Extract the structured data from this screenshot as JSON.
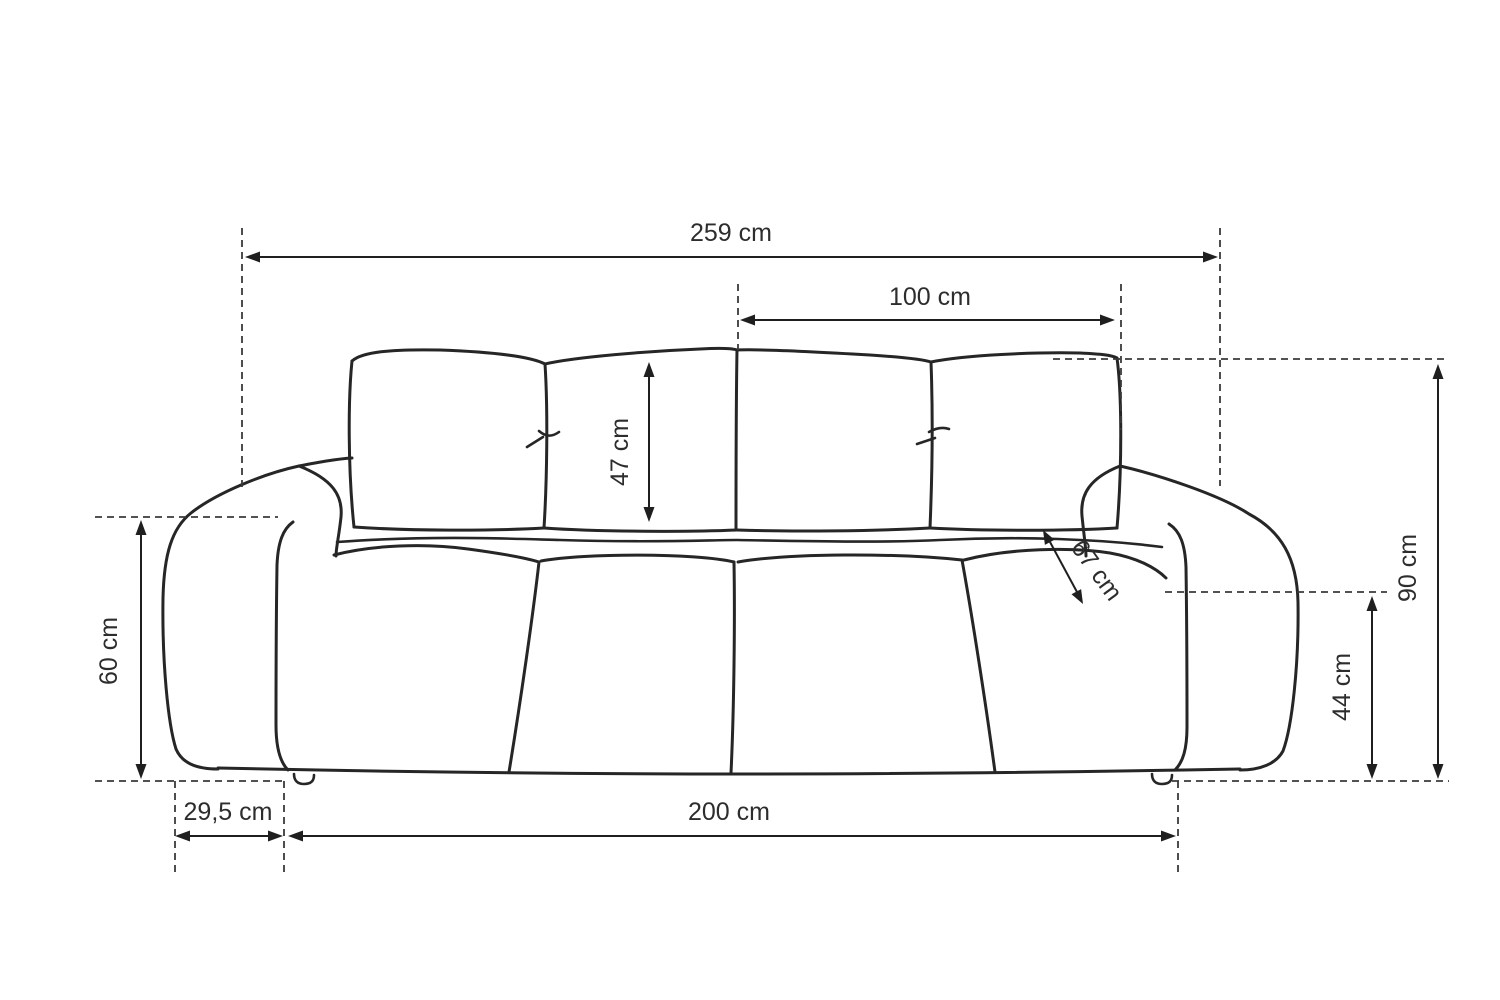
{
  "diagram": {
    "subject": "sofa front-view dimension drawing",
    "unit": "cm",
    "dimensions": {
      "total_width": "259 cm",
      "backrest_cushion_pair_width": "100 cm",
      "back_cushion_height": "47 cm",
      "seat_depth": "67 cm",
      "total_height": "90 cm",
      "seat_height": "44 cm",
      "armrest_height": "60 cm",
      "armrest_width": "29,5 cm",
      "seat_width": "200 cm"
    },
    "colors": {
      "background": "#ffffff",
      "sofa_outline": "#262626",
      "dimension_line": "#1f1f1f",
      "extension_line": "#3a3a3a",
      "label_text": "#2d2d2d"
    }
  }
}
